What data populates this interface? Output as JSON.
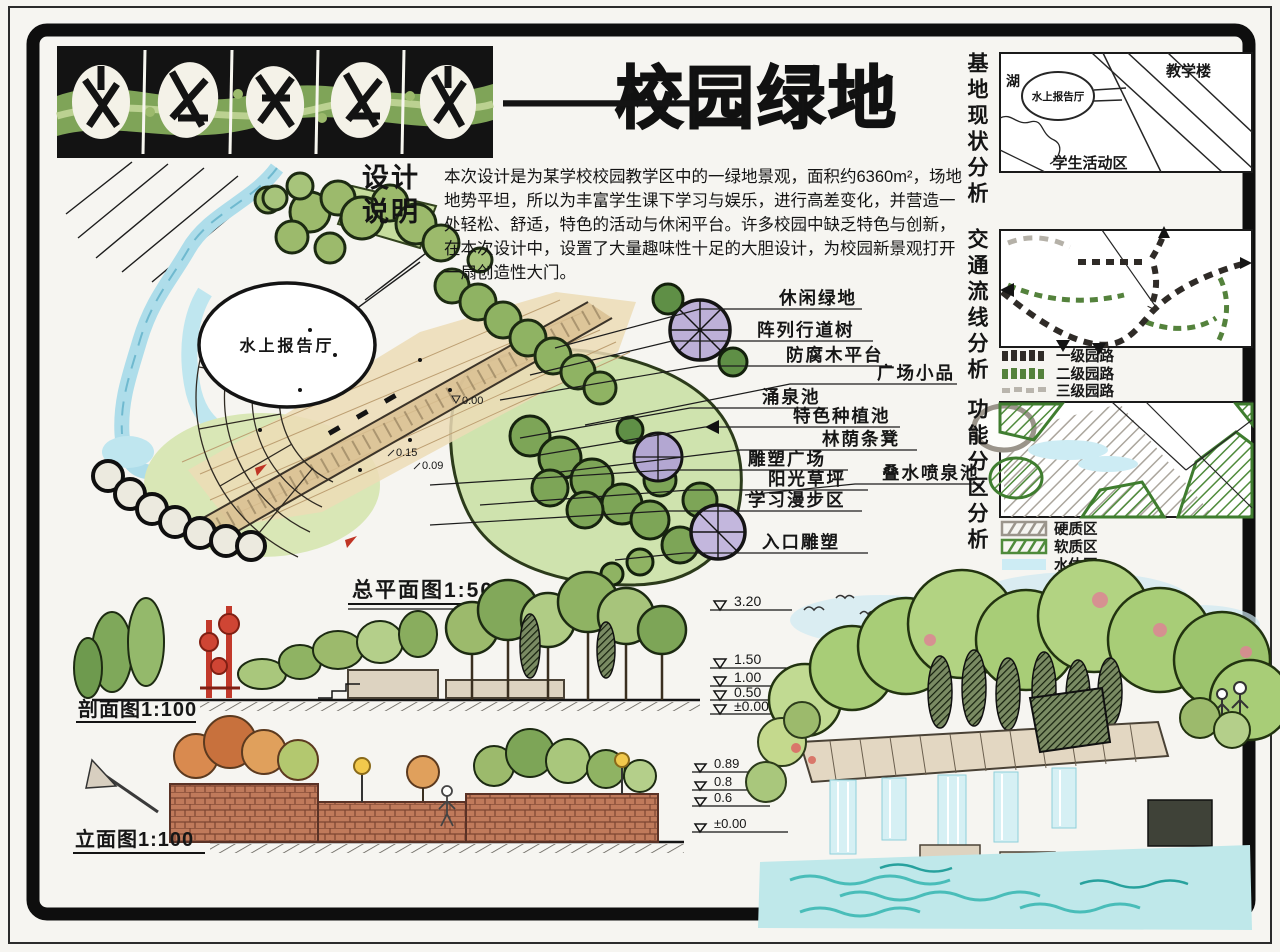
{
  "header": {
    "title_dash": "—",
    "title": "校园绿地"
  },
  "design_notes": {
    "heading": "设计\n说明",
    "body": "本次设计是为某学校校园教学区中的一绿地景观，面积约6360m²，场地地势平坦，所以为丰富学生课下学习与娱乐，进行高差变化，并营造一处轻松、舒适，特色的活动与休闲平台。许多校园中缺乏特色与创新，在本次设计中，设置了大量趣味性十足的大胆设计，为校园新景观打开一扇创造性大门。"
  },
  "master_plan": {
    "scale_label": "总平面图1:500",
    "hall_label": "水上报告厅",
    "callouts": [
      "休闲绿地",
      "阵列行道树",
      "防腐木平台",
      "广场小品",
      "涌泉池",
      "特色种植池",
      "林荫条凳",
      "雕塑广场",
      "阳光草坪",
      "叠水喷泉池",
      "学习漫步区",
      "入口雕塑"
    ],
    "spot_elevations": [
      "0.00",
      "0.15",
      "0.09"
    ]
  },
  "analysis_panels": {
    "site": {
      "title": "基地现状分析",
      "labels": {
        "lake": "湖",
        "hall": "水上报告厅",
        "teaching_building": "教学楼",
        "student_activity_area": "学生活动区"
      }
    },
    "circulation": {
      "title": "交通流线分析",
      "legend": [
        {
          "label": "一级园路",
          "color": "#2f2b27"
        },
        {
          "label": "二级园路",
          "color": "#54823c"
        },
        {
          "label": "三级园路",
          "color": "#b9b5ad"
        }
      ]
    },
    "zoning": {
      "title": "功能分区分析",
      "legend": [
        {
          "label": "硬质区",
          "color": "#9b958c"
        },
        {
          "label": "软质区",
          "color": "#4f8b3b"
        },
        {
          "label": "水体区",
          "color": "#cdecf4"
        }
      ]
    }
  },
  "section_view": {
    "scale_label": "剖面图1:100",
    "elevation_marks": [
      "3.20",
      "1.50",
      "1.00",
      "0.50",
      "±0.00"
    ]
  },
  "elevation_view": {
    "scale_label": "立面图1:100",
    "elevation_marks": [
      "0.89",
      "0.8",
      "0.6",
      "±0.00"
    ]
  },
  "palette": {
    "ink": "#141414",
    "canopy_green": "#9cba6c",
    "dark_green": "#5f8f46",
    "water_blue": "#cdecf4",
    "path_beige": "#ead9b4",
    "purple_canopy": "#bdb0d8",
    "sculpture_red": "#c2392b",
    "brick": "#c07a5b",
    "title_band_green": "#7fa458"
  }
}
